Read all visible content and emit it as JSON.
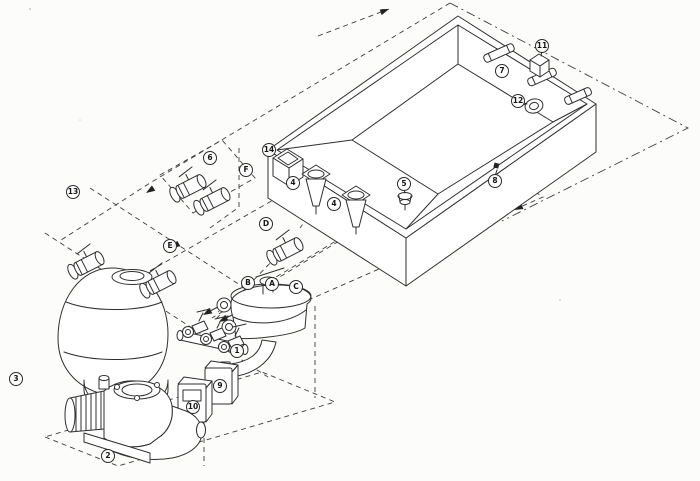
{
  "diagram": {
    "colors": {
      "background": "#fcfcfa",
      "line": "#2f2f2f",
      "dashed_line": "#3d3d3d",
      "arrow": "#222222"
    },
    "callouts": [
      {
        "label": "1",
        "x": 237,
        "y": 351,
        "target": "valve-manifold"
      },
      {
        "label": "2",
        "x": 108,
        "y": 456,
        "target": "pump"
      },
      {
        "label": "3",
        "x": 16,
        "y": 379,
        "target": "sand-filter"
      },
      {
        "label": "4",
        "x": 293,
        "y": 183,
        "target": "suction-wall-fitting"
      },
      {
        "label": "4",
        "x": 334,
        "y": 204,
        "target": "suction-wall-fitting"
      },
      {
        "label": "5",
        "x": 404,
        "y": 184,
        "target": "main-drain"
      },
      {
        "label": "6",
        "x": 210,
        "y": 158,
        "target": "shut-off-valves"
      },
      {
        "label": "7",
        "x": 502,
        "y": 71,
        "target": "wall-conduit"
      },
      {
        "label": "8",
        "x": 495,
        "y": 181,
        "target": "wall-inlet-fitting"
      },
      {
        "label": "9",
        "x": 220,
        "y": 386,
        "target": "control-box"
      },
      {
        "label": "10",
        "x": 193,
        "y": 407,
        "target": "control-box-window"
      },
      {
        "label": "11",
        "x": 542,
        "y": 46,
        "target": "junction-box"
      },
      {
        "label": "12",
        "x": 518,
        "y": 101,
        "target": "return-eyeball-fitting"
      },
      {
        "label": "13",
        "x": 73,
        "y": 192,
        "target": "pipe-trench"
      },
      {
        "label": "14",
        "x": 269,
        "y": 150,
        "target": "skimmer"
      },
      {
        "label": "A",
        "x": 272,
        "y": 284,
        "target": "pipe-run-a"
      },
      {
        "label": "B",
        "x": 248,
        "y": 283,
        "target": "pipe-run-b"
      },
      {
        "label": "C",
        "x": 296,
        "y": 287,
        "target": "pipe-run-c"
      },
      {
        "label": "D",
        "x": 266,
        "y": 224,
        "target": "pipe-run-d"
      },
      {
        "label": "E",
        "x": 170,
        "y": 246,
        "target": "pipe-run-e"
      },
      {
        "label": "F",
        "x": 246,
        "y": 170,
        "target": "pipe-run-f"
      }
    ]
  }
}
